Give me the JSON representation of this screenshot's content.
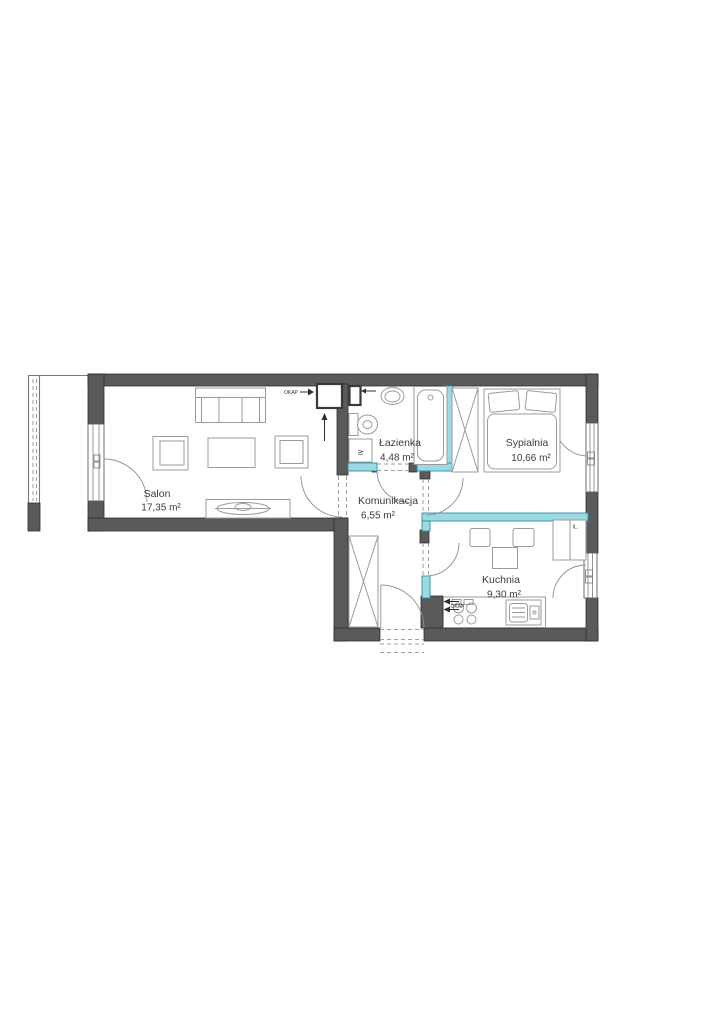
{
  "colors": {
    "wall": "#5a5a5d",
    "wall-line": "#2f2f2f",
    "partition": "#9dd9e3",
    "partition-line": "#2f8fa5",
    "furniture": "#9b9b9b",
    "door": "#8f8f8f",
    "dash": "#9e9e9e",
    "text": "#3c3c3c"
  },
  "plan": {
    "rooms": [
      {
        "name": "Salon",
        "area": "17,35 m²"
      },
      {
        "name": "Łazienka",
        "area": "4,48 m²"
      },
      {
        "name": "Sypialnia",
        "area": "10,66 m²"
      },
      {
        "name": "Komunikacja",
        "area": "6,55 m²"
      },
      {
        "name": "Kuchnia",
        "area": "9,30 m²"
      }
    ],
    "labels": {
      "hood_top": "OKAP",
      "hood_kitchen": "OKAP",
      "fridge": "lL.",
      "washer": "≥"
    }
  }
}
